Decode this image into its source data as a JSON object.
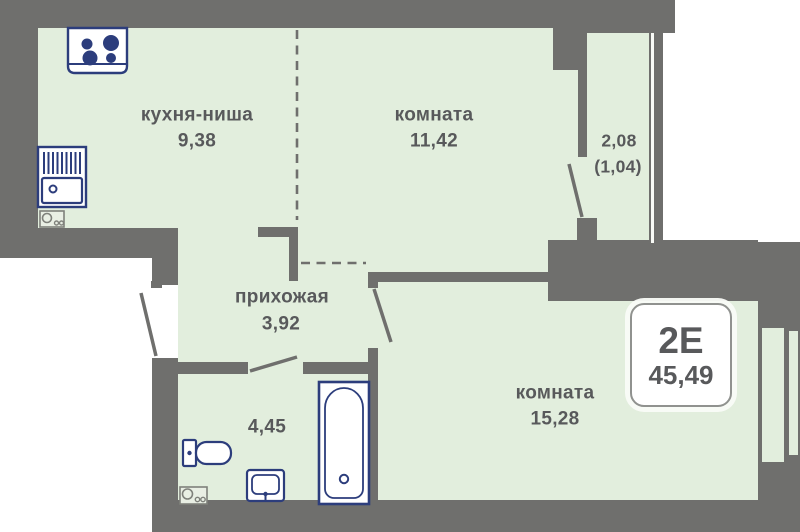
{
  "title": "floor-plan",
  "colors": {
    "wall": "#6f6f6d",
    "room": "#e2eedd",
    "outside": "#ffffff",
    "fixture": "#2c3d7c",
    "text": "#58595b",
    "riser": "#7f817b",
    "glass": "#f8faf6"
  },
  "rooms": {
    "kitchen": {
      "name": "кухня-ниша",
      "area": "9,38"
    },
    "room1": {
      "name": "комната",
      "area": "11,42"
    },
    "balcony": {
      "area": "2,08",
      "area_coefficient": "(1,04)"
    },
    "hallway": {
      "name": "прихожая",
      "area": "3,92"
    },
    "bathroom": {
      "area": "4,45"
    },
    "room2": {
      "name": "комната",
      "area": "15,28"
    }
  },
  "badge": {
    "apartment_type": "2Е",
    "total_area": "45,49"
  },
  "fixtures": {
    "stove": "stove-icon",
    "kitchen_sink": "kitchen-sink-icon",
    "utility_riser_kitchen": "utility-riser-icon",
    "toilet": "toilet-icon",
    "washbasin": "washbasin-icon",
    "bathtub": "bathtub-icon",
    "utility_riser_bath": "utility-riser-icon"
  }
}
